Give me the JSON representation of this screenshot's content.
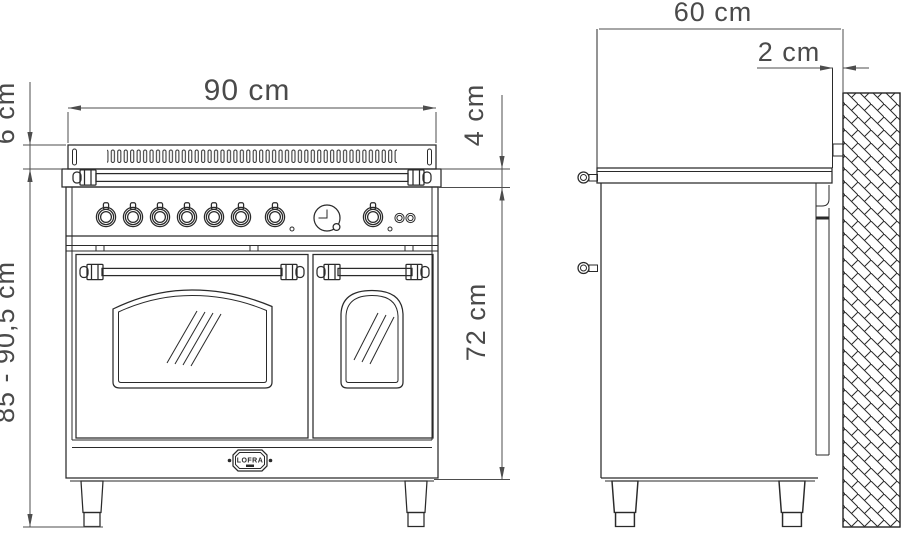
{
  "drawing": {
    "title": "range-cooker-installation-dimensions",
    "front_view": {
      "width": "90 cm",
      "upstand_height": "6 cm",
      "overall_height": "85 - 90,5 cm",
      "control_band_height": "4 cm",
      "door_section_height": "72 cm",
      "brand": "LOFRA"
    },
    "side_view": {
      "depth": "60 cm",
      "wall_clearance": "2 cm"
    },
    "colors": {
      "object_line": "#2a2a2a",
      "dimension_line": "#4d4d4d",
      "background": "#ffffff"
    }
  }
}
